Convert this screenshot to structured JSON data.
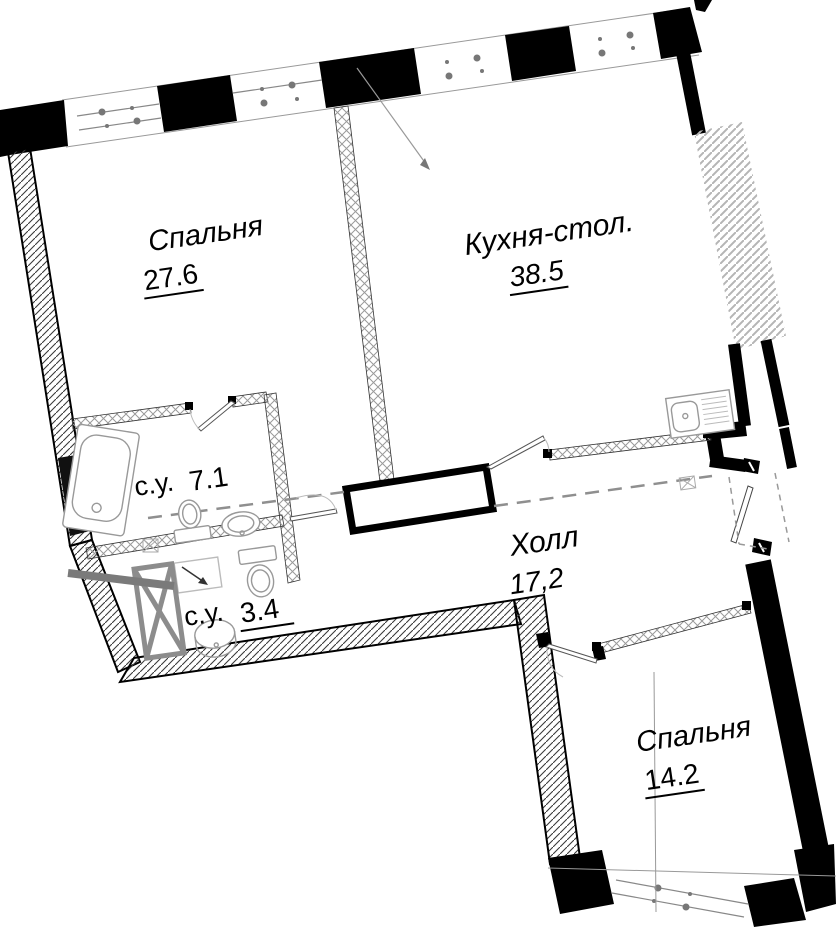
{
  "plan": {
    "title": "apartment-floor-plan",
    "rooms": [
      {
        "id": "bedroom-1",
        "name": "Спальня",
        "area": "27.6",
        "underlined": true
      },
      {
        "id": "kitchen",
        "name": "Кухня-стол.",
        "area": "38.5",
        "underlined": true
      },
      {
        "id": "bathroom-1",
        "name": "с.у.",
        "area": "7.1",
        "underlined": false
      },
      {
        "id": "bathroom-2",
        "name": "с.у.",
        "area": "3.4",
        "underlined": true
      },
      {
        "id": "hall",
        "name": "Холл",
        "area": "17,2",
        "underlined": false
      },
      {
        "id": "bedroom-2",
        "name": "Спальня",
        "area": "14.2",
        "underlined": true
      }
    ],
    "fixtures": [
      "bathtub",
      "toilet",
      "washbasin",
      "kitchen-sink",
      "shower-tray",
      "vent-shaft"
    ],
    "colors": {
      "wall": "#000000",
      "partition_hatch": "#9a9a9a",
      "exterior_hatch": "#3a3a3a",
      "neighbor_hatch": "#b5b5b5",
      "dashed_zone": "#8f8f8f",
      "fixture_outline": "#999999",
      "axis_line": "#888888"
    }
  }
}
